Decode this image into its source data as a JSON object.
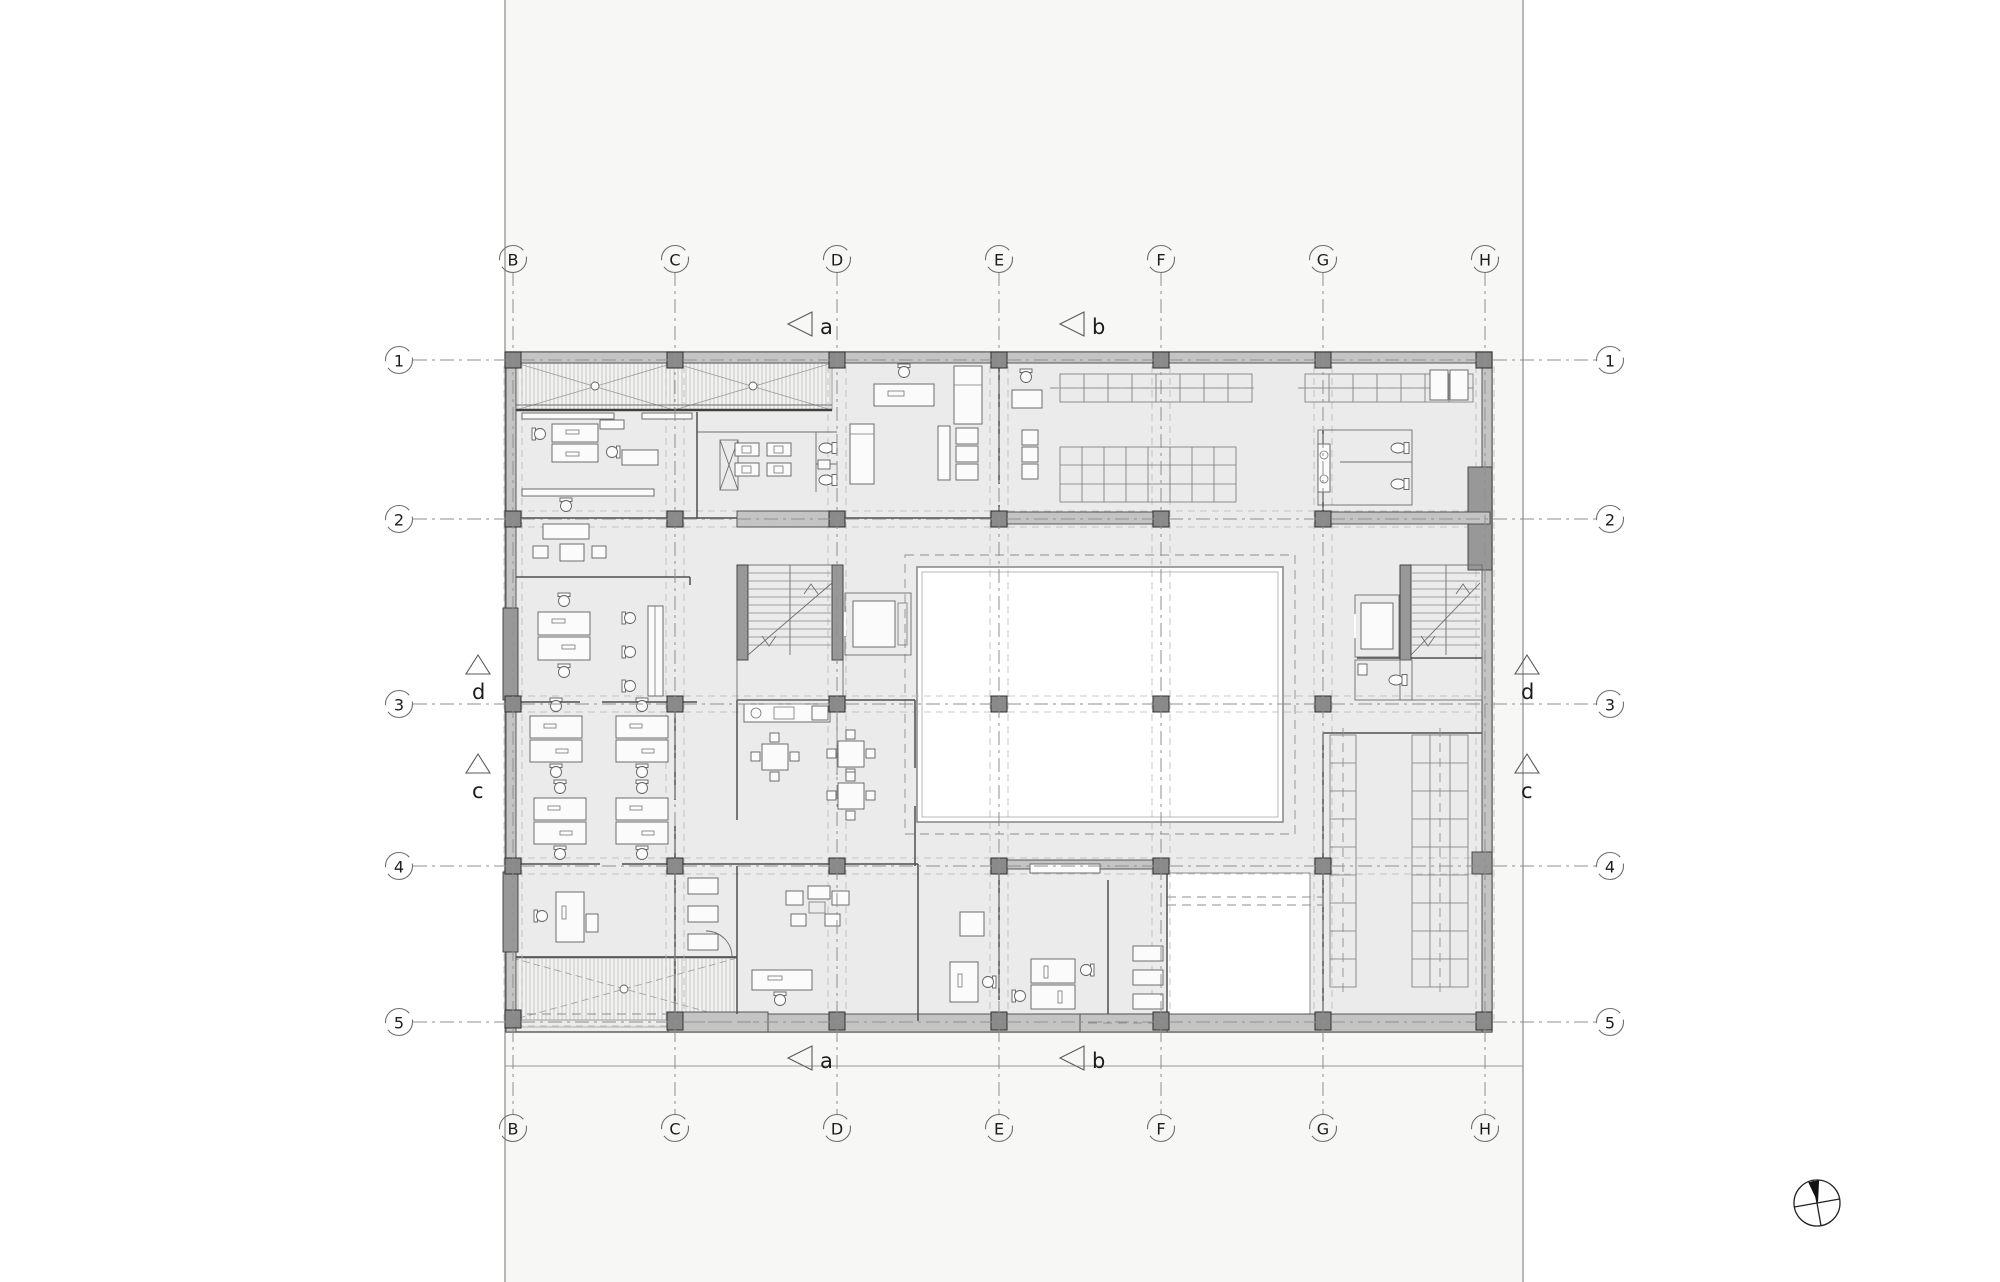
{
  "grid": {
    "columns": [
      {
        "label": "B"
      },
      {
        "label": "C"
      },
      {
        "label": "D"
      },
      {
        "label": "E"
      },
      {
        "label": "F"
      },
      {
        "label": "G"
      },
      {
        "label": "H"
      }
    ],
    "rows": [
      {
        "label": "1"
      },
      {
        "label": "2"
      },
      {
        "label": "3"
      },
      {
        "label": "4"
      },
      {
        "label": "5"
      }
    ]
  },
  "section_markers": {
    "a": {
      "label": "a"
    },
    "b": {
      "label": "b"
    },
    "c": {
      "label": "c"
    },
    "d": {
      "label": "d"
    }
  },
  "icons": {
    "compass": "north-arrow-compass"
  },
  "colors": {
    "sheet": "#f7f7f6",
    "floor": "#ebebeb",
    "wall": "#c4c4c4",
    "column": "#8a8a8a",
    "grid": "#8f8f8f",
    "guide": "#b6b6b6",
    "courtyard": "#ffffff"
  }
}
